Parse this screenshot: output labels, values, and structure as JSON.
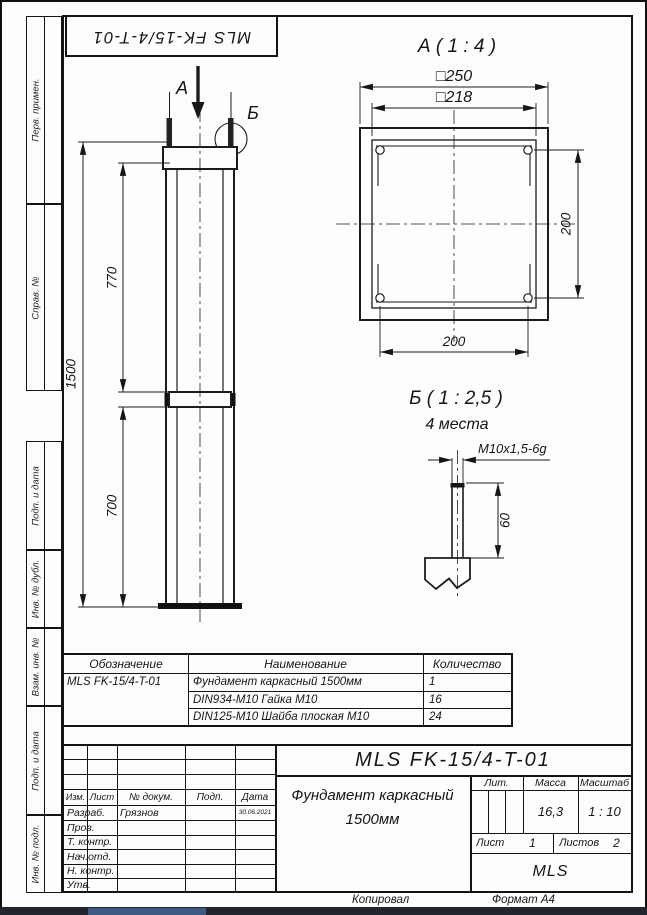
{
  "sheet": {
    "designation_top": "MLS FK-15/4-T-01",
    "copied_label": "Копировал",
    "format_label": "Формат А4"
  },
  "sidebar": {
    "items": [
      "Перв. примен.",
      "Справ. №",
      "Подп. и дата",
      "Инв. № дубл.",
      "Взам. инв. №",
      "Подп. и дата",
      "Инв. № подл."
    ]
  },
  "main_view": {
    "section_arrow_label": "А",
    "detail_circle_label": "Б",
    "dim_770": "770",
    "dim_700": "700",
    "dim_1500": "1500"
  },
  "detail_a": {
    "title": "А ( 1 : 4 )",
    "dim_outer": "□250",
    "dim_inner": "□218",
    "dim_bolt_horizontal": "200",
    "dim_bolt_vertical": "200"
  },
  "detail_b": {
    "title": "Б ( 1 : 2,5 )",
    "places": "4 места",
    "thread": "M10x1,5-6g",
    "dim_length": "60"
  },
  "parts_table": {
    "headers": [
      "Обозначение",
      "Наименование",
      "Количество"
    ],
    "rows": [
      [
        "MLS FK-15/4-T-01",
        "Фундамент каркасный 1500мм",
        "1"
      ],
      [
        "",
        "DIN934-M10 Гайка М10",
        "16"
      ],
      [
        "",
        "DIN125-M10 Шайба плоская М10",
        "24"
      ]
    ]
  },
  "title_block": {
    "designation": "MLS FK-15/4-T-01",
    "title_line1": "Фундамент каркасный",
    "title_line2": "1500мм",
    "lit_label": "Лит.",
    "mass_label": "Масса",
    "scale_label": "Масштаб",
    "mass_value": "16,3",
    "scale_value": "1 : 10",
    "sheet_label": "Лист",
    "sheet_value": "1",
    "sheets_label": "Листов",
    "sheets_value": "2",
    "company": "MLS",
    "header_cols": [
      "Изм.",
      "Лист",
      "№ докум.",
      "Подп.",
      "Дата"
    ],
    "sign_rows": [
      {
        "label": "Разраб.",
        "name": "Грязнов",
        "date": "30.06.2021"
      },
      {
        "label": "Пров.",
        "name": "",
        "date": ""
      },
      {
        "label": "Т. контр.",
        "name": "",
        "date": ""
      },
      {
        "label": "Нач.отд.",
        "name": "",
        "date": ""
      },
      {
        "label": "Н. контр.",
        "name": "",
        "date": ""
      },
      {
        "label": "Утв.",
        "name": "",
        "date": ""
      }
    ]
  }
}
